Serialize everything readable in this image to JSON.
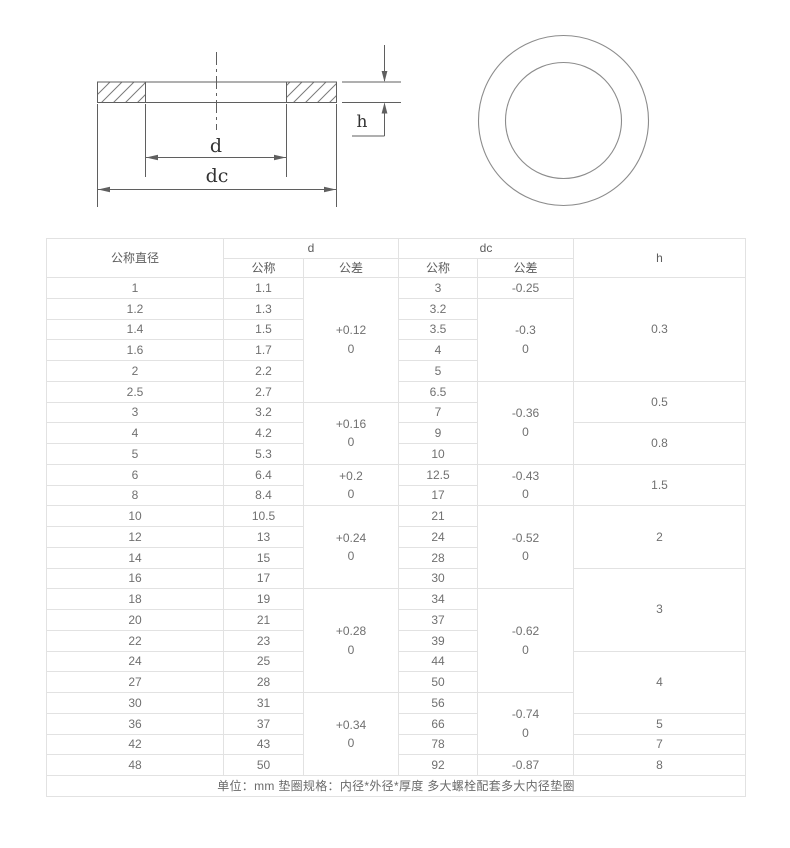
{
  "drawing": {
    "cross_section_labels": {
      "d": "d",
      "dc": "dc",
      "h": "h"
    }
  },
  "colors": {
    "drawing_line": "#5f5f5f",
    "hatch_line": "#7a7a7a",
    "circle_line": "#8c8c8c",
    "label_text": "#333333",
    "table_border": "#e2e2e2",
    "table_text": "#707070"
  },
  "table": {
    "header": {
      "nominal_diameter": "公称直径",
      "d_group": "d",
      "dc_group": "dc",
      "h": "h",
      "d_nominal": "公称",
      "d_tolerance": "公差",
      "dc_nominal": "公称",
      "dc_tolerance": "公差"
    },
    "rows": [
      {
        "nominal": "1",
        "d_nominal": "1.1",
        "d_tol": {
          "text": "+0.12\n0",
          "span": 6
        },
        "dc_nominal": "3",
        "dc_tol": {
          "text": "-0.25",
          "span": 1
        },
        "h": {
          "text": "0.3",
          "span": 5
        }
      },
      {
        "nominal": "1.2",
        "d_nominal": "1.3",
        "dc_nominal": "3.2",
        "dc_tol": {
          "text": "-0.3\n0",
          "span": 4
        }
      },
      {
        "nominal": "1.4",
        "d_nominal": "1.5",
        "dc_nominal": "3.5"
      },
      {
        "nominal": "1.6",
        "d_nominal": "1.7",
        "dc_nominal": "4"
      },
      {
        "nominal": "2",
        "d_nominal": "2.2",
        "dc_nominal": "5"
      },
      {
        "nominal": "2.5",
        "d_nominal": "2.7",
        "dc_nominal": "6.5",
        "dc_tol": {
          "text": "-0.36\n0",
          "span": 4
        },
        "h": {
          "text": "0.5",
          "span": 2
        }
      },
      {
        "nominal": "3",
        "d_nominal": "3.2",
        "d_tol": {
          "text": "+0.16\n0",
          "span": 3
        },
        "dc_nominal": "7"
      },
      {
        "nominal": "4",
        "d_nominal": "4.2",
        "dc_nominal": "9",
        "h": {
          "text": "0.8",
          "span": 2
        }
      },
      {
        "nominal": "5",
        "d_nominal": "5.3",
        "dc_nominal": "10"
      },
      {
        "nominal": "6",
        "d_nominal": "6.4",
        "d_tol": {
          "text": "+0.2\n0",
          "span": 2
        },
        "dc_nominal": "12.5",
        "dc_tol": {
          "text": "-0.43\n0",
          "span": 2
        },
        "h": {
          "text": "1.5",
          "span": 2
        }
      },
      {
        "nominal": "8",
        "d_nominal": "8.4",
        "dc_nominal": "17"
      },
      {
        "nominal": "10",
        "d_nominal": "10.5",
        "d_tol": {
          "text": "+0.24\n0",
          "span": 4
        },
        "dc_nominal": "21",
        "dc_tol": {
          "text": "-0.52\n0",
          "span": 4
        },
        "h": {
          "text": "2",
          "span": 3
        }
      },
      {
        "nominal": "12",
        "d_nominal": "13",
        "dc_nominal": "24"
      },
      {
        "nominal": "14",
        "d_nominal": "15",
        "dc_nominal": "28"
      },
      {
        "nominal": "16",
        "d_nominal": "17",
        "dc_nominal": "30",
        "h": {
          "text": "3",
          "span": 4
        }
      },
      {
        "nominal": "18",
        "d_nominal": "19",
        "d_tol": {
          "text": "+0.28\n0",
          "span": 5
        },
        "dc_nominal": "34",
        "dc_tol": {
          "text": "-0.62\n0",
          "span": 5
        }
      },
      {
        "nominal": "20",
        "d_nominal": "21",
        "dc_nominal": "37"
      },
      {
        "nominal": "22",
        "d_nominal": "23",
        "dc_nominal": "39"
      },
      {
        "nominal": "24",
        "d_nominal": "25",
        "dc_nominal": "44",
        "h": {
          "text": "4",
          "span": 3
        }
      },
      {
        "nominal": "27",
        "d_nominal": "28",
        "dc_nominal": "50"
      },
      {
        "nominal": "30",
        "d_nominal": "31",
        "d_tol": {
          "text": "+0.34\n0",
          "span": 4
        },
        "dc_nominal": "56",
        "dc_tol": {
          "text": "-0.74\n0",
          "span": 3
        }
      },
      {
        "nominal": "36",
        "d_nominal": "37",
        "dc_nominal": "66",
        "h": {
          "text": "5",
          "span": 1
        }
      },
      {
        "nominal": "42",
        "d_nominal": "43",
        "dc_nominal": "78",
        "h": {
          "text": "7",
          "span": 1
        }
      },
      {
        "nominal": "48",
        "d_nominal": "50",
        "dc_nominal": "92",
        "dc_tol": {
          "text": "-0.87",
          "span": 1
        },
        "h": {
          "text": "8",
          "span": 1
        }
      }
    ],
    "footer_note": "单位：mm 垫圈规格：内径*外径*厚度 多大螺栓配套多大内径垫圈"
  }
}
